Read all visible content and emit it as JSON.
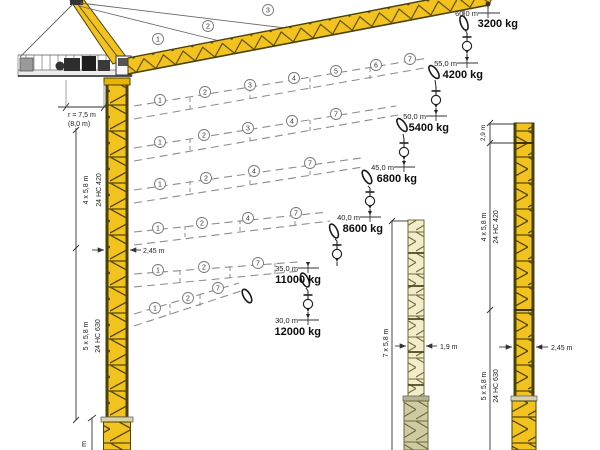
{
  "diagram_title": "Tower crane jib configurations and load capacities",
  "configurations": [
    {
      "radius": "60,0 m",
      "capacity": "3200 kg"
    },
    {
      "radius": "55,0 m",
      "capacity": "4200 kg"
    },
    {
      "radius": "50,0 m",
      "capacity": "5400 kg"
    },
    {
      "radius": "45,0 m",
      "capacity": "6800 kg"
    },
    {
      "radius": "40,0 m",
      "capacity": "8600 kg"
    },
    {
      "radius": "35,0 m",
      "capacity": "11000 kg"
    },
    {
      "radius": "30,0 m",
      "capacity": "12000 kg"
    }
  ],
  "sections": [
    "1",
    "2",
    "3",
    "4",
    "5",
    "6",
    "7"
  ],
  "main_crane": {
    "radius_note": "r = 7,5 m",
    "radius_note_alt": "(8,0 m)",
    "upper_sections": "4 x 5,8 m",
    "upper_type": "24 HC 420",
    "lower_sections": "5 x 5,8 m",
    "lower_type": "24 HC 630",
    "width": "2,45 m",
    "cutoff_label": "m"
  },
  "middle_tower": {
    "sections": "7 x 5,8 m",
    "width": "1,9 m"
  },
  "right_tower": {
    "top_piece": "2,9 m",
    "upper_sections": "4 x 5,8 m",
    "upper_type": "24 HC 420",
    "lower_sections": "5 x 5,8 m",
    "lower_type": "24 HC 630",
    "width": "2,45 m"
  },
  "colors": {
    "crane_yellow": "#f2c31f",
    "pale_lattice": "#f1ecca",
    "lattice_dark": "#4a4208",
    "dash_grey": "#8c8c8c",
    "base_grey": "#d8d2ac"
  }
}
